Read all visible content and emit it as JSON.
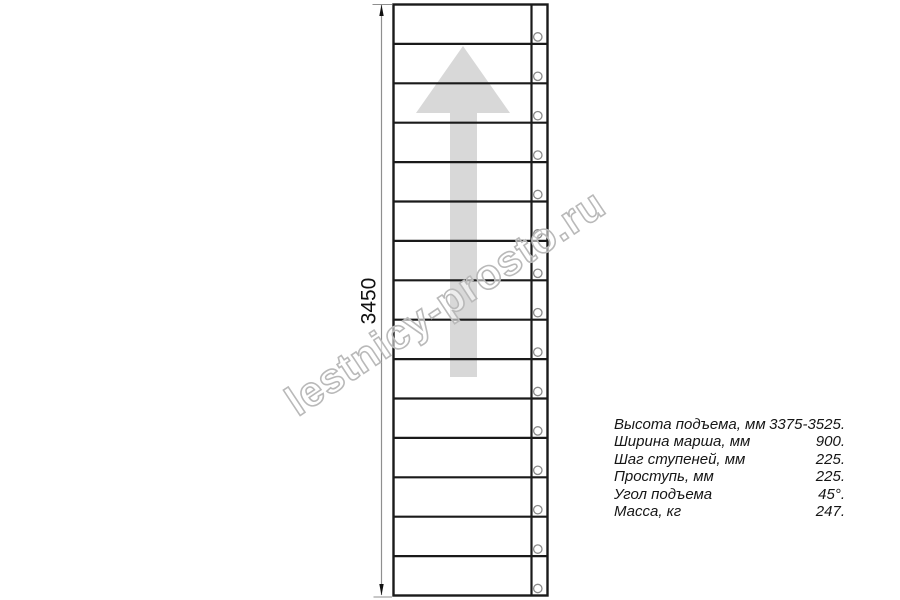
{
  "watermark": {
    "text": "lestnicy-prosto.ru"
  },
  "drawing": {
    "dimension_label": "3450",
    "treads": 15,
    "holes": 15,
    "arrow_direction": "up",
    "colors": {
      "outline": "#1a1a1a",
      "arrow_fill": "#d8d8d8",
      "dimension_line": "#8f8f8f",
      "hole_stroke": "#8a8a8a",
      "watermark_stroke": "#b9b9b9",
      "watermark_fill": "rgba(255,255,255,0.55)",
      "text": "#111111"
    }
  },
  "specs": {
    "rows": [
      {
        "label": "Высота подъема, мм",
        "value": "3375-3525."
      },
      {
        "label": "Ширина марша, мм",
        "value": "900."
      },
      {
        "label": "Шаг ступеней, мм",
        "value": "225."
      },
      {
        "label": "Проступь, мм",
        "value": "225."
      },
      {
        "label": "Угол подъема",
        "value": "45°."
      },
      {
        "label": "Масса, кг",
        "value": "247."
      }
    ]
  }
}
